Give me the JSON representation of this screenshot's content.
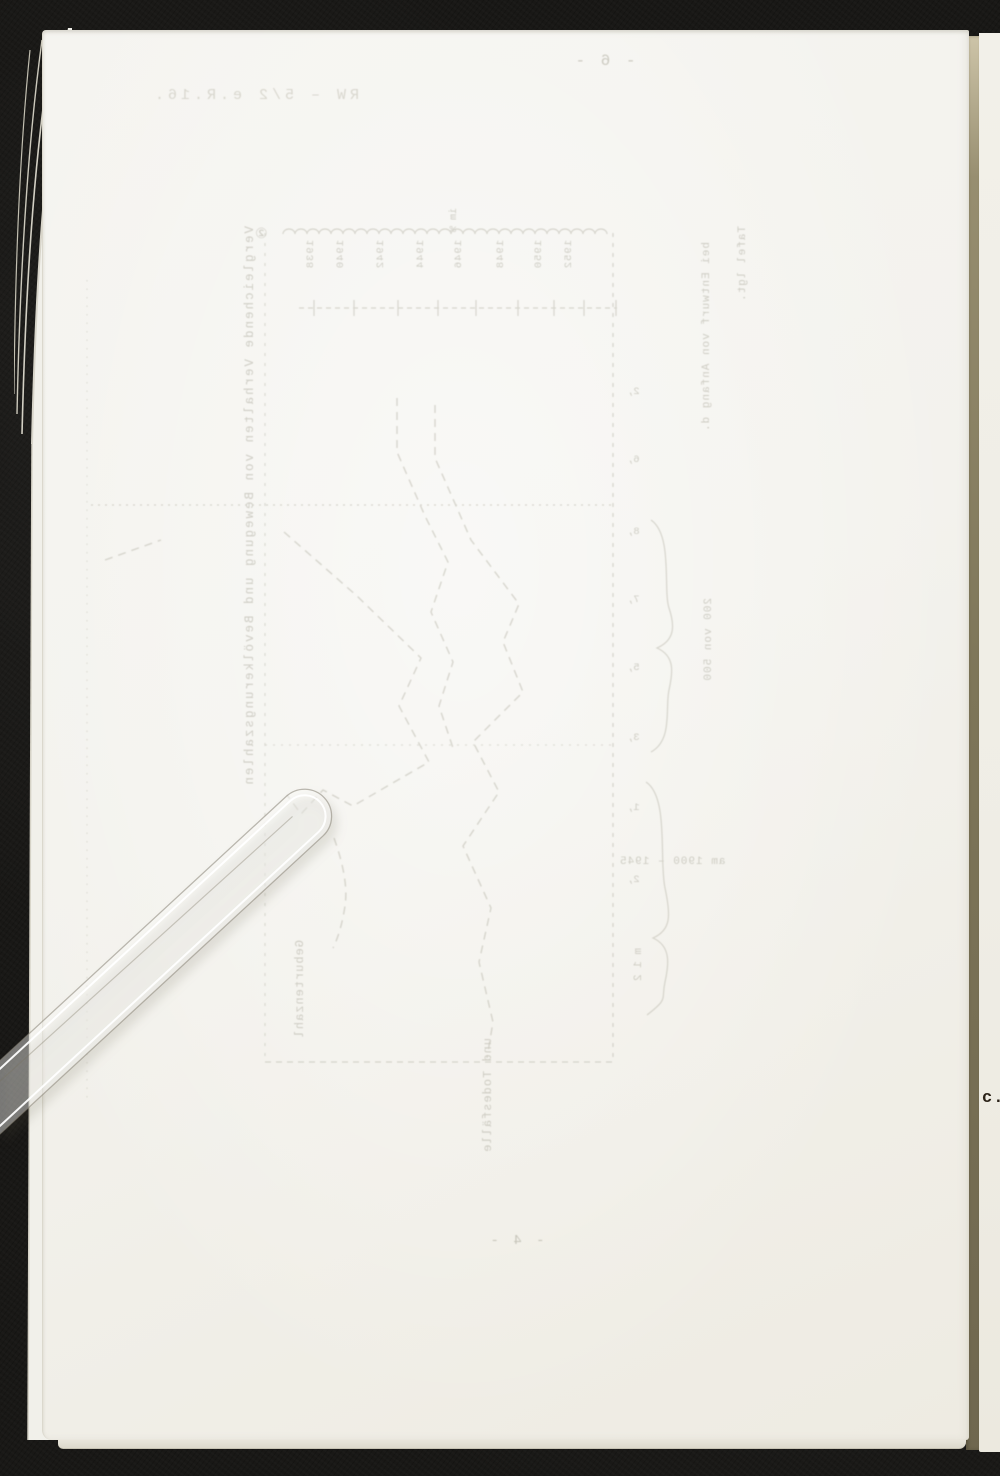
{
  "scan": {
    "right_page_visible_text": "c.)"
  },
  "showthrough": {
    "top_page_number": "- 6 -",
    "stamp_line": "RW – 5/2 e.R.16.",
    "figure_mark": "②",
    "caption_vertical": "Vergleichende Verhalten von Bewegung und Bevölkerungszahlen",
    "note_line_1": "Tafel lgt.",
    "note_line_2": "bei Entwurf von Anfang d.",
    "unit_note": "im %",
    "axis_years": [
      "1952",
      "1950",
      "1948",
      "1946",
      "1944",
      "1942",
      "1940",
      "1938"
    ],
    "right_axis_ticks": [
      "2,",
      "6,",
      "8,",
      "7,",
      "5,",
      "3,",
      "1,",
      "2,"
    ],
    "brace_label_1": "200 von 500",
    "brace_label_2": "am 1900 – 1945",
    "scale_note": "m 1 2",
    "left_curve_label": "Geburtenzahl",
    "bottom_curve_label": "und Todesfälle",
    "bottom_page_number": "- 4 -"
  },
  "colors": {
    "background": "#151412",
    "paper": "#f3f2ed",
    "paper_next_page": "#f0eee7",
    "page_gap_shadow": "#7e7659",
    "ghost_ink": "#aeac9f",
    "dark_ink": "#2b2318"
  }
}
